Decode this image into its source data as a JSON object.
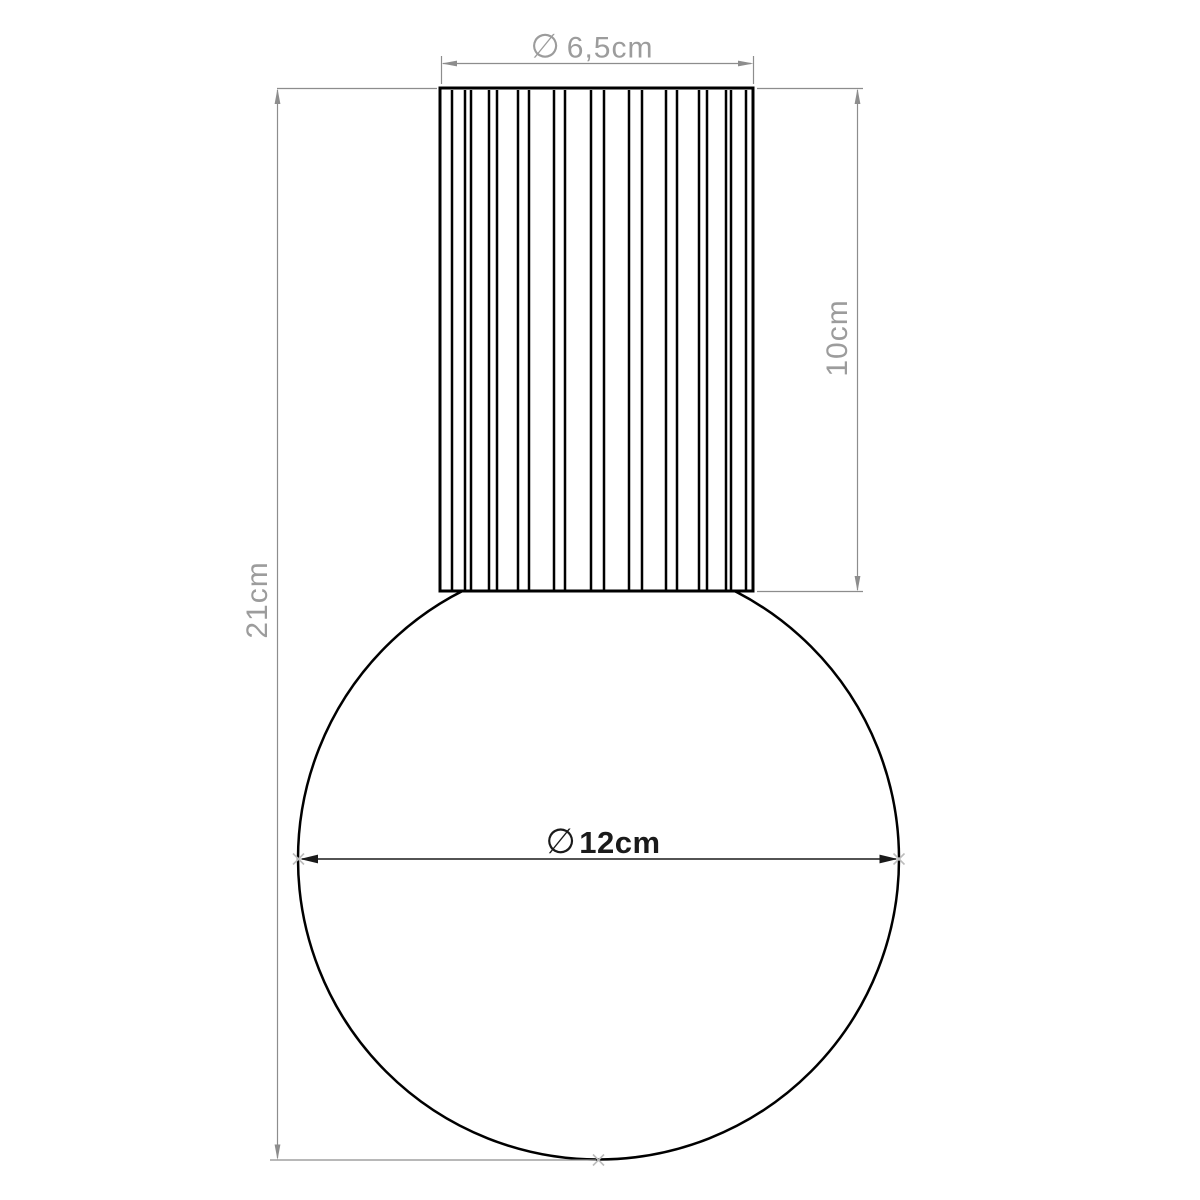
{
  "drawing": {
    "labels": {
      "top_diameter": {
        "symbol": "∅",
        "value": "6,5cm"
      },
      "shaft_height": {
        "value": "10cm"
      },
      "total_height": {
        "value": "21cm"
      },
      "globe_diameter": {
        "symbol": "∅",
        "value": "12cm"
      }
    },
    "colors": {
      "outline_black": "#000000",
      "dim_black": "#1a1a1a",
      "dim_gray": "#8d8d8d",
      "text_gray": "#9c9c9c",
      "marker_gray": "#bdbdbd",
      "background": "#ffffff"
    }
  }
}
